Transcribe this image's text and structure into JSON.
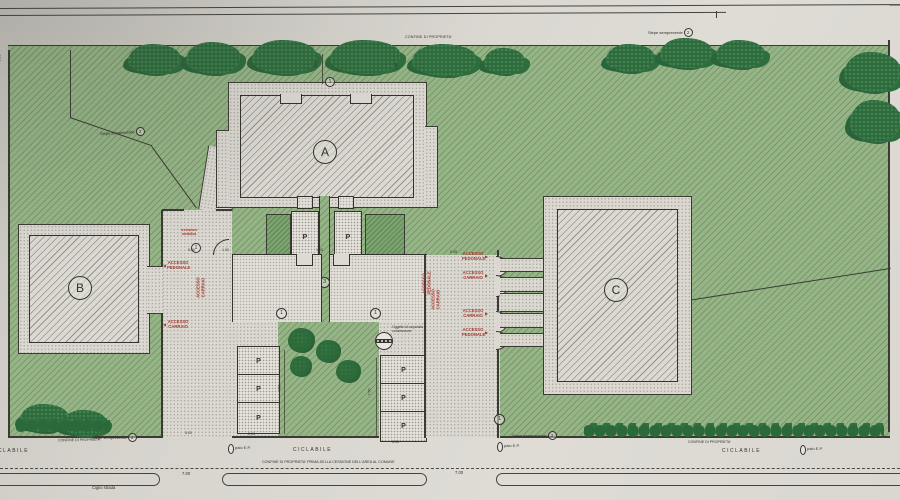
{
  "plan": {
    "building_a": "A",
    "building_b": "B",
    "building_c": "C",
    "stall": "P",
    "accesso_pedonale": "ACCESSO PEDONALE",
    "accesso_carraio": "ACCESSO CARRAIO",
    "confine": "CONFINE DI PROPRIETA'",
    "confine_cessione": "CONFINE DI PROPRIETA' PRIMA DELLA CESSIONE DELL'AREA AL COMUNE",
    "ciclabile": "CICLABILE",
    "palo_ep": "palo E.P.",
    "ciglio_strada": "Ciglio strada",
    "siepe": "Siepe sempreverde",
    "recinzione": "recinzione metallica",
    "oggetto": "Oggetto di separata concessione",
    "ref1": "1",
    "ref2": "2",
    "ref3": "3",
    "dim_500": "5.00",
    "dim_700": "7.00",
    "dim_750": "7.50",
    "dim_100": "1.00",
    "dim_505": "5.05",
    "dim_150": "1.50",
    "dim_550": "5.50",
    "arrow_left": "◀",
    "arrow_right": "▶",
    "colors": {
      "lawn": "#94b285",
      "tree": "#2c6a3a",
      "paper": "#dcdad3",
      "label_red": "#a63a2e",
      "ink": "#3b3a33"
    }
  }
}
